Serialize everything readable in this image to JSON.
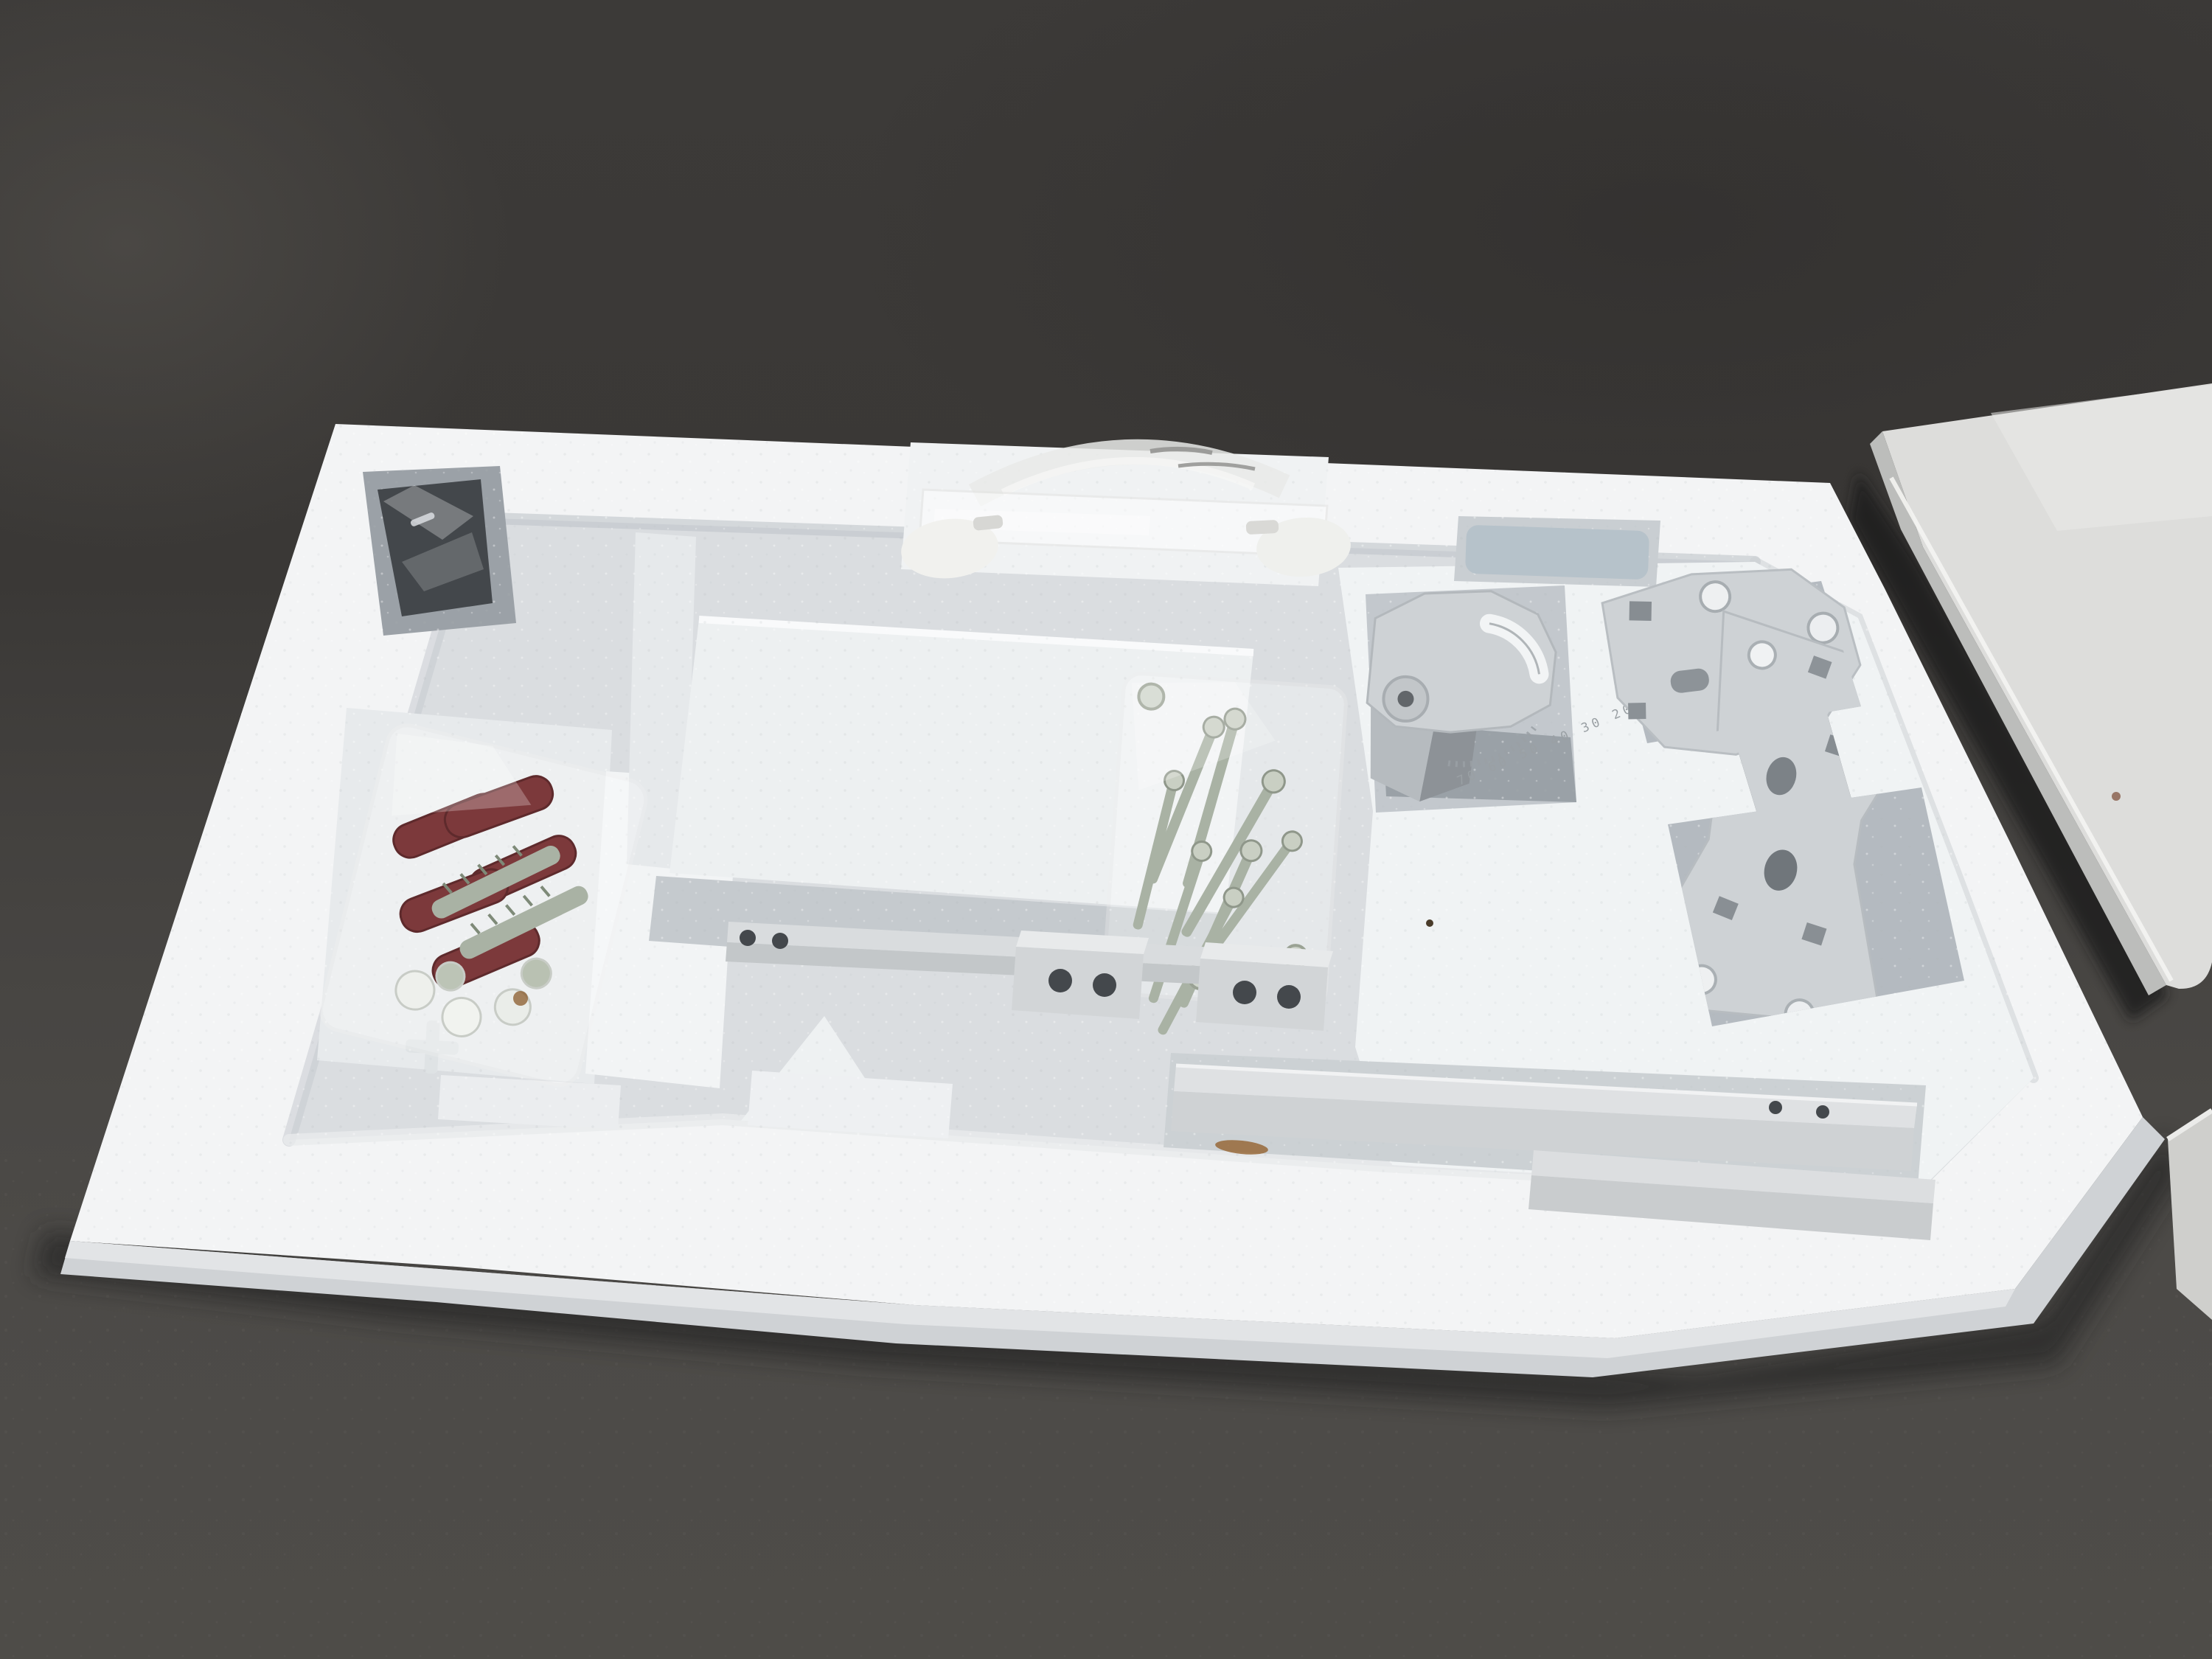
{
  "scene": {
    "description": "Opened TV wall-mount bracket kit resting in a white molded styrofoam packaging tray on a dark charcoal surface; white product box lid partially visible at right",
    "background": {
      "upper_wall": "#3a3836",
      "lower_surface": "#4d4b48",
      "shadow": "#242322"
    },
    "palette": {
      "foam_bright": "#f3f4f5",
      "foam_mid": "#dadde0",
      "foam_recess": "#b6bcc1",
      "foam_deep": "#8e959b",
      "metal": "#ced2d5",
      "metal_shadow": "#aeb4b8",
      "rail": "#dfe1e3",
      "hole_dark": "#44484c",
      "zinc": "#a9b2a4",
      "zinc_bright": "#c9cfc3",
      "anchor_red": "#7c393b",
      "bag_white": "#ffffff",
      "handle_plastic": "#f1f1ee",
      "blue_part": "#b6c2ca",
      "box_face": "#dddddb",
      "box_bevel": "#bcbdbb",
      "panel": "#cfcfcc",
      "stain": "#8a5a2a"
    },
    "tilt_bracket": {
      "scale_markings": "70 60 50 40 30 20"
    },
    "items": [
      {
        "id": "styrofoam-tray",
        "label": "white molded styrofoam packaging tray"
      },
      {
        "id": "carry-handle",
        "label": "translucent plastic carry handle with two oval end caps"
      },
      {
        "id": "anchor-bag",
        "label": "plastic bag with dark red wall anchors and zinc hex bolts"
      },
      {
        "id": "screws-bag",
        "label": "plastic bag with assorted zinc screws"
      },
      {
        "id": "tilt-bracket",
        "label": "gray tilt bracket with curved slot, rivet and angle scale"
      },
      {
        "id": "flat-bracket",
        "label": "perforated flat mounting bracket"
      },
      {
        "id": "vesa-plate",
        "label": "bowtie-shaped VESA adapter plate with square and round holes"
      },
      {
        "id": "long-rail",
        "label": "long white mounting rail with two holes"
      },
      {
        "id": "short-rail",
        "label": "second white mounting rail"
      },
      {
        "id": "thin-bar",
        "label": "thin slotted bar with two holes"
      },
      {
        "id": "angle-bracket-left",
        "label": "angle bracket end with two holes"
      },
      {
        "id": "angle-bracket-right",
        "label": "angle bracket end with two holes"
      },
      {
        "id": "wrapped-part",
        "label": "dark metal part wrapped in clear plastic"
      },
      {
        "id": "blue-part",
        "label": "pale blue-gray plastic part in recess"
      },
      {
        "id": "product-box-lid",
        "label": "white product box lid"
      },
      {
        "id": "white-panel",
        "label": "white panel edge at lower right"
      },
      {
        "id": "rust-stain",
        "label": "small brown rust stain on foam"
      }
    ]
  }
}
